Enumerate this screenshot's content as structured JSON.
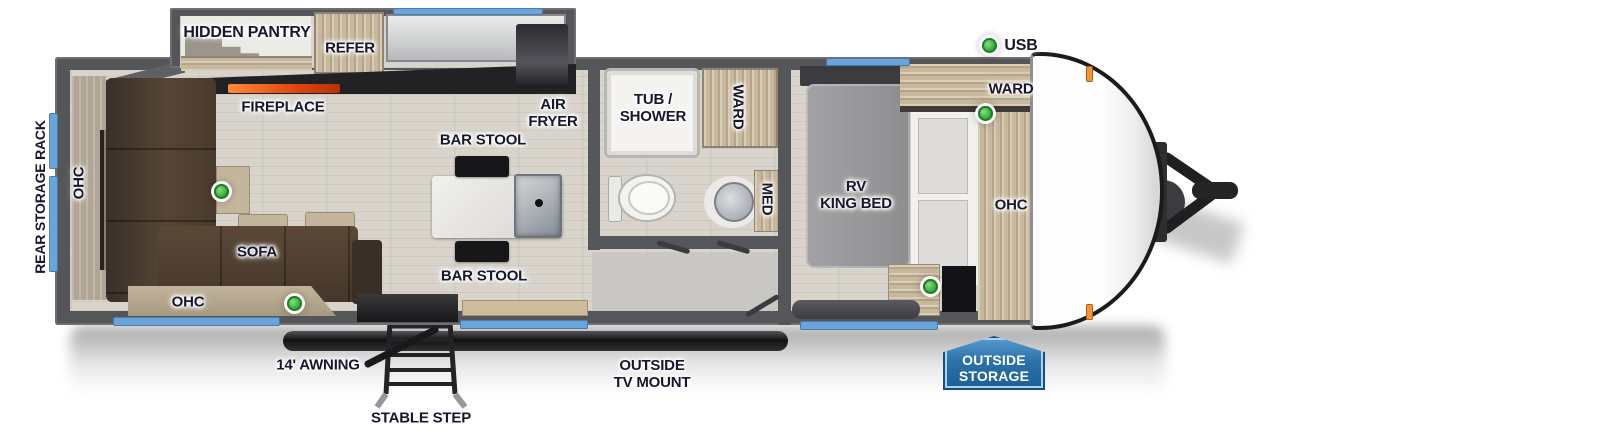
{
  "colors": {
    "window_blue": "#6aa4d8",
    "badge_blue_light": "#5b9fd0",
    "badge_blue_dark": "#1d5d95",
    "usb_green": "#3cb24a",
    "marker_orange": "#f09637",
    "fireplace_orange": "#e2450e"
  },
  "legend": {
    "usb": "USB"
  },
  "exterior": {
    "rear_storage_rack": "REAR STORAGE RACK",
    "awning": "14' AWNING",
    "stable_step": "STABLE STEP",
    "outside_tv_mount": "OUTSIDE\nTV MOUNT",
    "outside_storage": "OUTSIDE\nSTORAGE"
  },
  "living": {
    "ohc_left": "OHC",
    "ohc_bottom": "OHC",
    "sofa": "SOFA",
    "fireplace": "FIREPLACE"
  },
  "kitchen": {
    "hidden_pantry": "HIDDEN PANTRY",
    "refer": "REFER",
    "air_fryer": "AIR\nFRYER",
    "bar_stool_top": "BAR STOOL",
    "bar_stool_bottom": "BAR STOOL"
  },
  "bath": {
    "tub_shower": "TUB /\nSHOWER",
    "ward": "WARD",
    "med": "MED"
  },
  "bedroom": {
    "rv_king_bed": "RV\nKING BED",
    "ward": "WARD",
    "ohc": "OHC"
  }
}
